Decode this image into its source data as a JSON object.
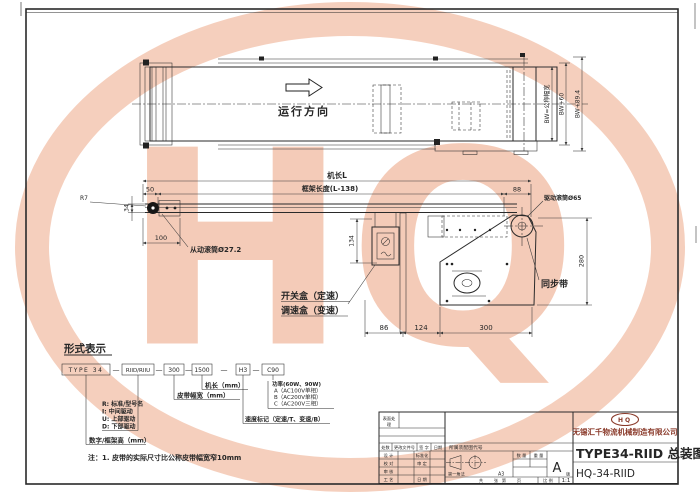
{
  "colors": {
    "watermark": "#f3c3ac",
    "logo_red": "#8a3a2a",
    "line": "#2a2a2a"
  },
  "watermark": {
    "text": "HQ"
  },
  "plan": {
    "direction": "运行方向",
    "dim_bw": "BW=公称幅宽",
    "dim_bw60": "BW+60",
    "dim_bw894": "BW+89.4"
  },
  "side": {
    "machine_length": "机长L",
    "frame_length": "框架长度(L-138)",
    "d50": "50",
    "d88": "88",
    "r7": "R7",
    "d34": "34",
    "d100": "100",
    "driven_roller": "从动滚筒Ø27.2",
    "drive_roller": "驱动滚筒Ø65",
    "d134": "134",
    "d280": "280",
    "d86": "86",
    "d124": "124",
    "d300": "300",
    "sync_belt": "同步带",
    "switch_box": "开关盒（定速）",
    "speed_box": "调速盒（变速）"
  },
  "model": {
    "heading": "形式表示",
    "b1": "TYPE 34",
    "b2": "RIID/RIIU",
    "b3": "300",
    "b4": "1500",
    "b5": "H3",
    "b6": "C90",
    "dash": "—",
    "machine_len_label": "机长（mm）",
    "belt_width_label": "皮带幅宽（mm）",
    "r1": "R: 标准/型号名",
    "r2": "I: 中间驱动",
    "r3": "U: 上部驱动",
    "r4": "D: 下部驱动",
    "frame_h_label": "数字/框架高（mm）",
    "p1": "功率(60W、90W)",
    "p2": "A（AC100V单相）",
    "p3": "B（AC200V单相）",
    "p4": "C（AC200V三相）",
    "speed_label": "速度标记（定速/T、变速/B）",
    "note": "注：1. 皮带的实际尺寸比公称皮带幅宽窄10mm"
  },
  "tb": {
    "surface1": "表面处",
    "surface2": "理",
    "chushu": "处数",
    "file": "更改文件号",
    "sign": "签 字",
    "riqi": "日期",
    "design": "设 计",
    "standardize": "标准化",
    "check": "校 对",
    "approve": "审 定",
    "review": "审 核",
    "process": "工 艺",
    "date2": "日 期",
    "assembly_code": "所属装配图代号",
    "projection": "第一角法",
    "sheet_size": "A3",
    "qty": "数 量",
    "weight": "重 量",
    "version": "A",
    "version_suffix": "版",
    "gong": "共",
    "zhang": "张",
    "di": "第",
    "ye": "页",
    "scale_label": "比 例",
    "scale_value": "1:1",
    "logo": "HQ",
    "company": "无锡汇千物流机械制造有限公司",
    "title": "TYPE34-RIID 总装图",
    "drawing_no": "HQ-34-RIID"
  }
}
